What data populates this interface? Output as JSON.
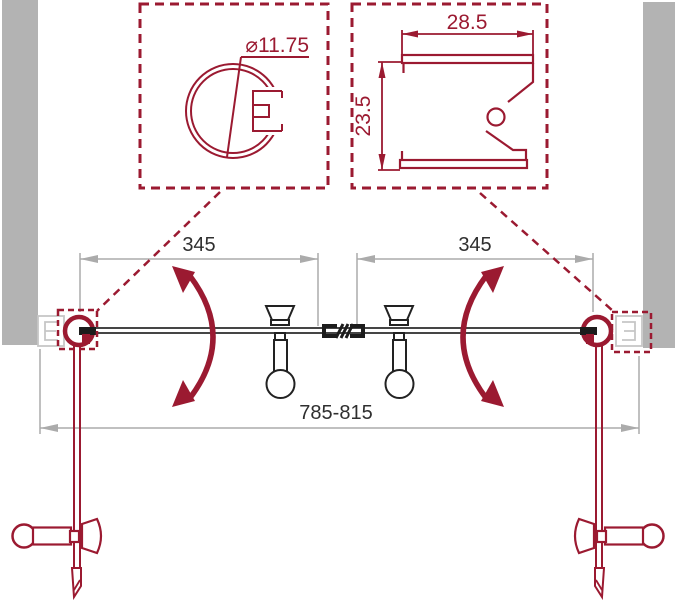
{
  "canvas": {
    "width": 680,
    "height": 600,
    "background": "#ffffff"
  },
  "palette": {
    "accent_red": "#9b1a31",
    "drawing_dark": "#222222",
    "dimension_gray": "#ababab",
    "text_dark": "#2f2f2f",
    "wall_gray": "#b3b3b3",
    "profile_outline_gray": "#c6c6c6"
  },
  "details": {
    "round_profile": {
      "diameter_label": "⌀11.75"
    },
    "wall_profile": {
      "width_label": "28.5",
      "height_label": "23.5"
    }
  },
  "dimensions": {
    "left_panel_width": "345",
    "right_panel_width": "345",
    "overall_width": "785-815"
  }
}
